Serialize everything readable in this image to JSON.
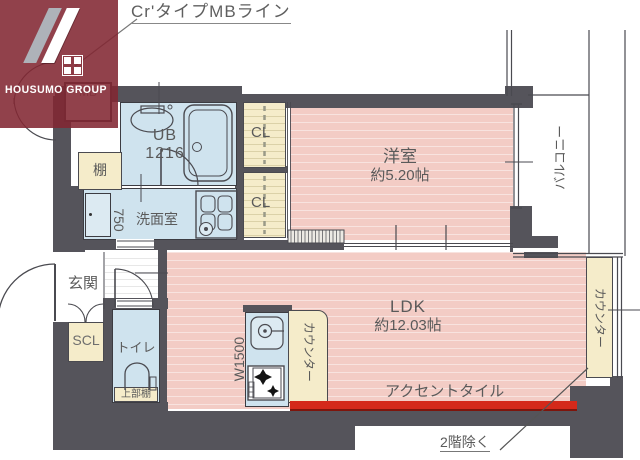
{
  "header": {
    "label": "Cr'タイプMBライン"
  },
  "logo": {
    "name": "HOUSUMO GROUP"
  },
  "rooms": {
    "mb": "MB",
    "ub_line1": "UB",
    "ub_line2": "1216",
    "shelf": "棚",
    "washroom": "洗面室",
    "dim_750": "750",
    "cl1": "CL",
    "cl2": "CL",
    "western_name": "洋室",
    "western_size": "約5.20帖",
    "balcony": "バルコニー",
    "entrance": "玄関",
    "scl": "SCL",
    "toilet": "トイレ",
    "upper_shelf": "上部棚",
    "ldk_name": "LDK",
    "ldk_size": "約12.03帖",
    "kitchen_width": "W1500",
    "counter_kitchen": "カウンター",
    "counter_right": "カウンター",
    "accent_tile": "アクセントタイル",
    "note_2f": "2階除く"
  },
  "colors": {
    "wall": "#55545b",
    "room_pink": "#f3ccc5",
    "wet_blue": "#cfe3ee",
    "closet_cream": "#f5ecca",
    "accent_red": "#d4291a",
    "logo_maroon": "#82272f",
    "line_gray": "#4a4a50"
  }
}
